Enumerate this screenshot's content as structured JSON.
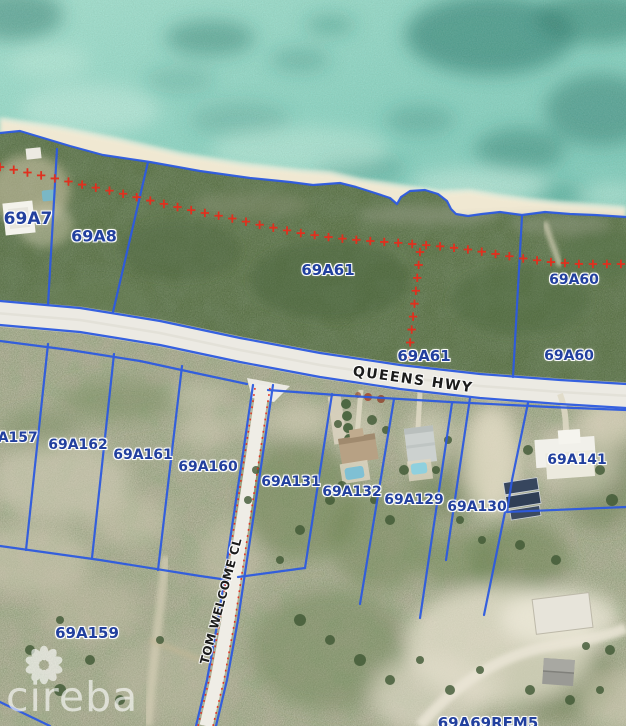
{
  "brand": {
    "name": "cireba"
  },
  "map": {
    "colors": {
      "parcel_line": "#2d5ae0",
      "label": "#22409e",
      "survey_red": "#e0301e",
      "road_label": "#1b1b1b"
    },
    "road_labels": [
      {
        "text": "QUEENS HWY",
        "x": 413,
        "y": 380,
        "rotation": 8,
        "size": 14,
        "letter_spacing": 1.5
      },
      {
        "text": "TOM WELCOME CL",
        "x": 221,
        "y": 601,
        "rotation": -75,
        "size": 12,
        "letter_spacing": 0.5
      }
    ],
    "parcel_labels": [
      {
        "text": "69A7",
        "x": 28,
        "y": 219,
        "size": 17
      },
      {
        "text": "69A8",
        "x": 94,
        "y": 236,
        "size": 16
      },
      {
        "text": "69A61",
        "x": 328,
        "y": 270,
        "size": 15
      },
      {
        "text": "69A60",
        "x": 574,
        "y": 280,
        "size": 14
      },
      {
        "text": "69A61",
        "x": 424,
        "y": 356,
        "size": 15
      },
      {
        "text": "69A60",
        "x": 569,
        "y": 356,
        "size": 14
      },
      {
        "text": "69A157",
        "x": 8,
        "y": 438,
        "size": 14
      },
      {
        "text": "69A162",
        "x": 78,
        "y": 445,
        "size": 14
      },
      {
        "text": "69A161",
        "x": 143,
        "y": 455,
        "size": 14
      },
      {
        "text": "69A160",
        "x": 208,
        "y": 467,
        "size": 14
      },
      {
        "text": "69A131",
        "x": 291,
        "y": 482,
        "size": 14
      },
      {
        "text": "69A132",
        "x": 352,
        "y": 492,
        "size": 14
      },
      {
        "text": "69A129",
        "x": 414,
        "y": 500,
        "size": 14
      },
      {
        "text": "69A130",
        "x": 477,
        "y": 507,
        "size": 14
      },
      {
        "text": "69A141",
        "x": 577,
        "y": 460,
        "size": 14
      },
      {
        "text": "69A159",
        "x": 87,
        "y": 633,
        "size": 15
      },
      {
        "text": "69A69REM5",
        "x": 488,
        "y": 723,
        "size": 15
      }
    ],
    "survey": {
      "cross_spacing": 14,
      "coast_line": [
        [
          0,
          167
        ],
        [
          35,
          174
        ],
        [
          75,
          183
        ],
        [
          120,
          193
        ],
        [
          160,
          203
        ],
        [
          195,
          211
        ],
        [
          230,
          218
        ],
        [
          265,
          226
        ],
        [
          300,
          233
        ],
        [
          335,
          238
        ],
        [
          370,
          241
        ],
        [
          400,
          243
        ],
        [
          437,
          246
        ],
        [
          465,
          249
        ],
        [
          490,
          253
        ],
        [
          520,
          258
        ],
        [
          550,
          262
        ],
        [
          580,
          264
        ],
        [
          626,
          264
        ]
      ],
      "branch_line": [
        [
          420,
          252
        ],
        [
          417,
          280
        ],
        [
          414,
          308
        ],
        [
          411,
          336
        ],
        [
          408,
          360
        ]
      ]
    }
  }
}
